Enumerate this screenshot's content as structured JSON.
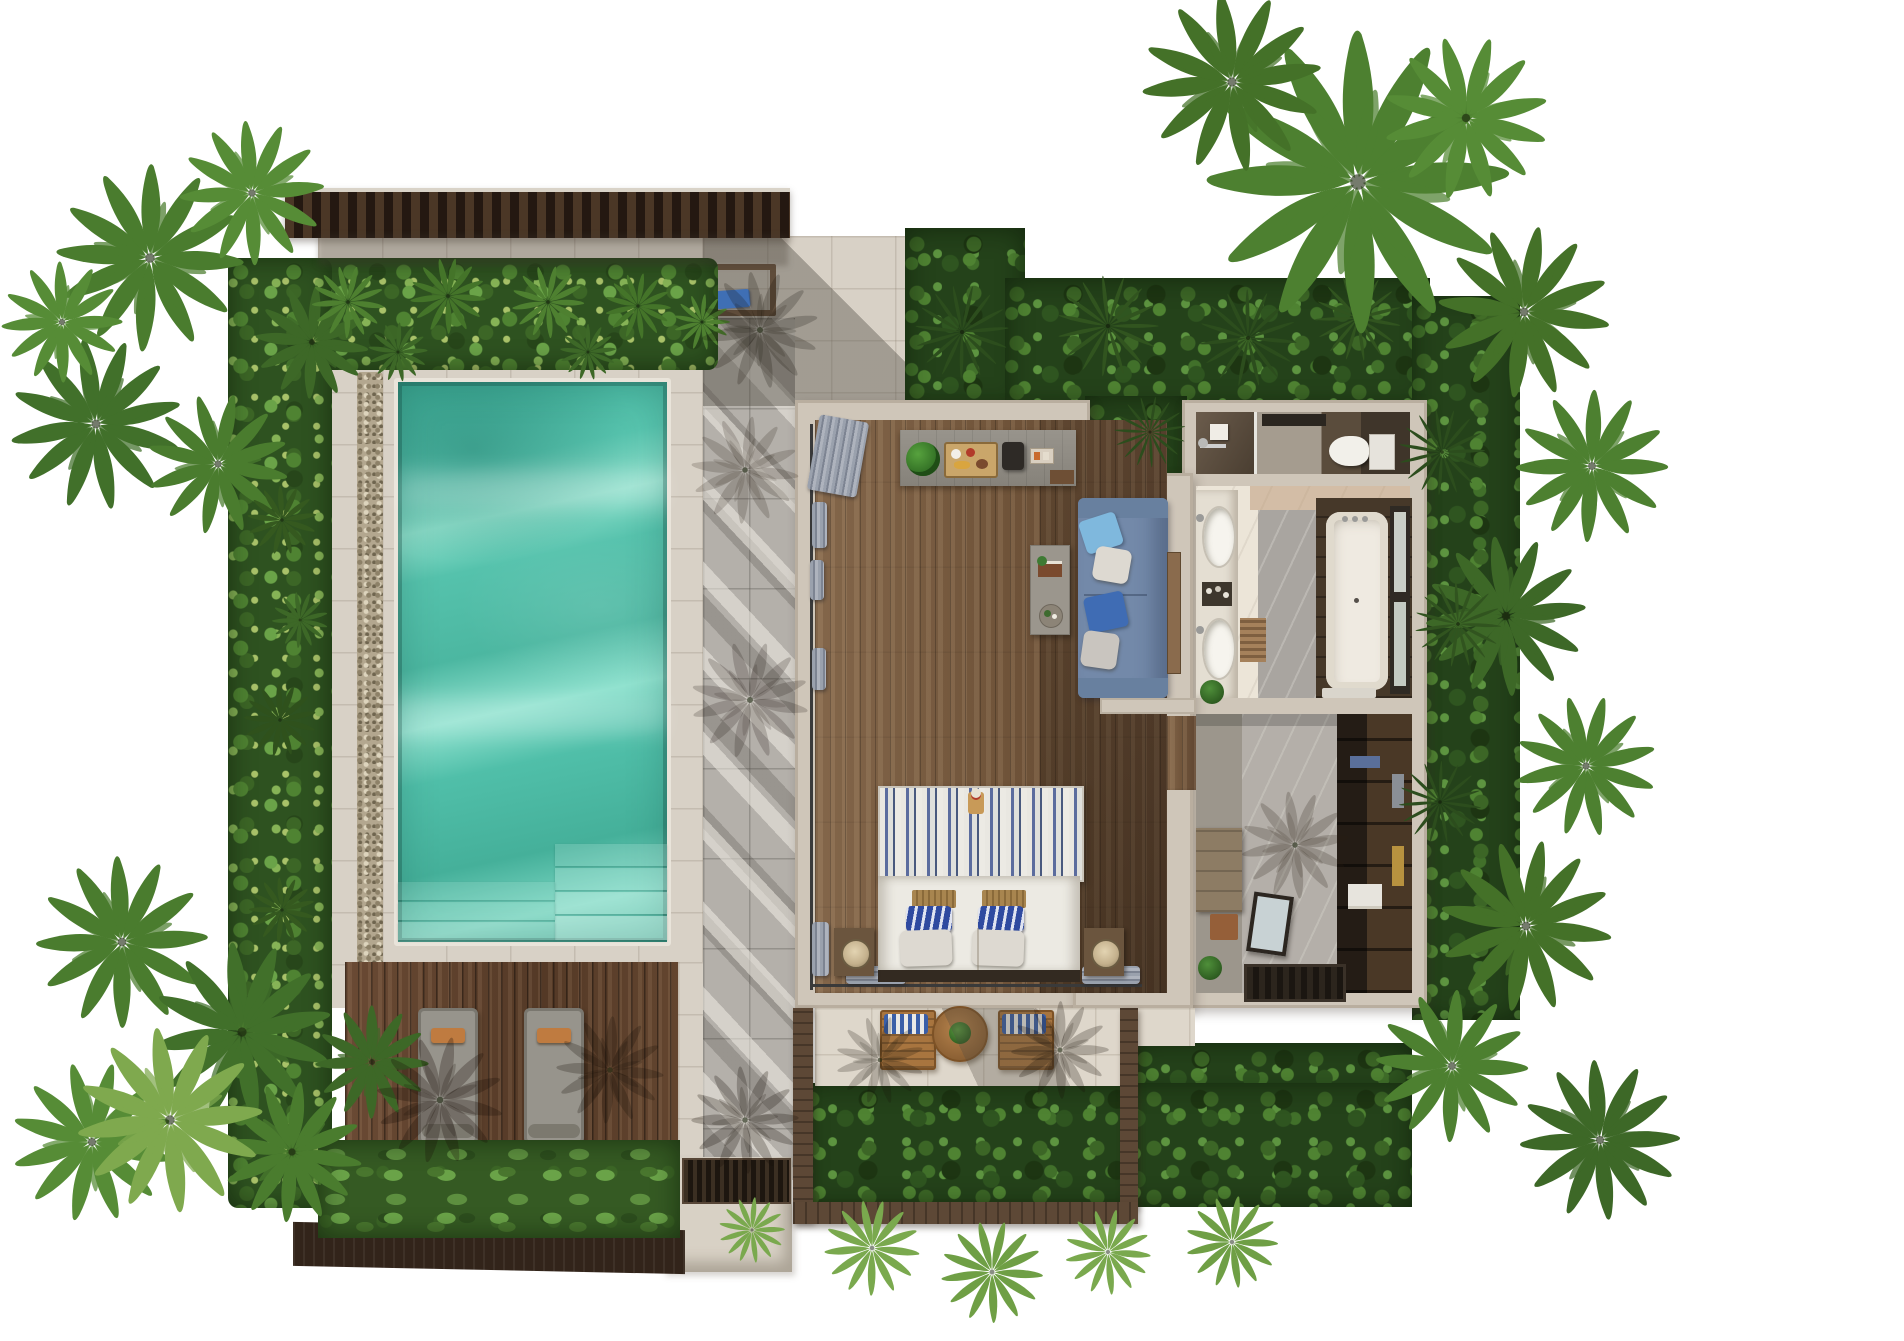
{
  "scene": {
    "type": "top-down 3D rendered floor plan",
    "setting": "tropical one-bedroom pool villa surrounded by palms and jungle hedges",
    "background": "#ffffff",
    "palette": {
      "pool_water": "#53c0aa",
      "pool_water_light": "#8fe0cc",
      "pool_water_dark": "#2e9d89",
      "stone_light": "#d8d1c6",
      "stone_terrace": "#ded7cb",
      "path_gray": "#b4b0aa",
      "gravel": "#b3a78f",
      "deck_wood": "#5e402c",
      "roof_wood": "#3a2a1c",
      "pergola_wood": "#5d4836",
      "villa_wall": "#cfc6b9",
      "wood_floor": "#7b5f45",
      "marble_cream": "#ece5d8",
      "marble_gray": "#a9a5a0",
      "sofa_blue": "#7389a9",
      "bed_stripe_blue": "#51628f",
      "pillow_blue": "#2f4aa0",
      "hedge_green": "#2e5220",
      "jungle_green": "#24421a",
      "palm_green": "#4a7c2e",
      "lounger_gray": "#97948c",
      "cushion_orange": "#bf7b40",
      "towel_blue": "#3f6fb5",
      "chair_wood": "#a8753f"
    },
    "rooms": [
      {
        "id": "bedroom",
        "label": "Bedroom & living area",
        "floor": "wide wooden planks"
      },
      {
        "id": "bathroom",
        "label": "Bathroom with double vanity and bathtub",
        "floor": "cream and gray marble"
      },
      {
        "id": "shower",
        "label": "Walk-in shower",
        "floor": "dark stone"
      },
      {
        "id": "wc",
        "label": "WC",
        "floor": "stone with dark zone"
      },
      {
        "id": "wardrobe",
        "label": "Walk-in wardrobe / dressing room",
        "floor": "marble"
      },
      {
        "id": "pool",
        "label": "Private swimming pool with corner entry steps"
      },
      {
        "id": "sundeck",
        "label": "Timber sun deck with two loungers"
      },
      {
        "id": "terrace",
        "label": "Covered terrace with chairs and round table"
      },
      {
        "id": "entry",
        "label": "Entry path and door mat"
      },
      {
        "id": "court",
        "label": "North stone court under timber roof"
      }
    ],
    "furniture": [
      "king bed with blue-white striped canopy headboard",
      "2 rattan bed trays",
      "2 blue patterned pillows",
      "2 white pillows",
      "2 nightstands with round lamps",
      "blue 3-seat sofa with 4 cushions",
      "narrow coffee table with book and round tray",
      "gray console sideboard with monstera plant, breakfast tray, coffee set and box",
      "gray curtains along glass walls",
      "double vanity with 2 oval sinks and amenity tray",
      "freestanding bathtub in dark timber deck beside window",
      "toilet",
      "rain shower with shelf",
      "dark wardrobe with clothes and shelves",
      "wooden dresser",
      "leaning mirror",
      "entry door mat",
      "2 potted plants",
      "2 gray sun loungers with orange pillows",
      "pool-side wooden bench with blue towels",
      "2 wooden terrace chairs with blue striped cushions",
      "round wooden terrace table with plant"
    ],
    "pool": {
      "steps": "corner staircase + full-width shallow entry",
      "gravel_border": true,
      "coping": "light stone"
    },
    "palms": [
      {
        "x": 150,
        "y": 258,
        "r": 96,
        "k": "c",
        "c": "#4a7c2e"
      },
      {
        "x": 252,
        "y": 193,
        "r": 74,
        "k": "c",
        "c": "#568c36"
      },
      {
        "x": 96,
        "y": 424,
        "r": 88,
        "k": "c",
        "c": "#41702a"
      },
      {
        "x": 218,
        "y": 464,
        "r": 72,
        "k": "c",
        "c": "#4a7c2e"
      },
      {
        "x": 312,
        "y": 342,
        "r": 58,
        "k": "c",
        "c": "#3d6827"
      },
      {
        "x": 62,
        "y": 322,
        "r": 62,
        "k": "c",
        "c": "#568c36"
      },
      {
        "x": 348,
        "y": 302,
        "r": 44,
        "k": "f",
        "c": "#4e8030"
      },
      {
        "x": 448,
        "y": 296,
        "r": 46,
        "k": "f",
        "c": "#447429"
      },
      {
        "x": 548,
        "y": 302,
        "r": 44,
        "k": "f",
        "c": "#4e8030"
      },
      {
        "x": 638,
        "y": 306,
        "r": 40,
        "k": "f",
        "c": "#447429"
      },
      {
        "x": 702,
        "y": 322,
        "r": 34,
        "k": "f",
        "c": "#4e8030"
      },
      {
        "x": 398,
        "y": 352,
        "r": 36,
        "k": "f",
        "c": "#3d6827"
      },
      {
        "x": 588,
        "y": 352,
        "r": 34,
        "k": "f",
        "c": "#3d6827"
      },
      {
        "x": 282,
        "y": 520,
        "r": 42,
        "k": "f",
        "c": "#35591f"
      },
      {
        "x": 280,
        "y": 720,
        "r": 44,
        "k": "f",
        "c": "#2f511c"
      },
      {
        "x": 282,
        "y": 910,
        "r": 40,
        "k": "f",
        "c": "#35591f"
      },
      {
        "x": 300,
        "y": 620,
        "r": 34,
        "k": "f",
        "c": "#3d6827"
      },
      {
        "x": 962,
        "y": 332,
        "r": 50,
        "k": "s",
        "c": "#2c4d1d"
      },
      {
        "x": 1108,
        "y": 326,
        "r": 54,
        "k": "s",
        "c": "#31541f"
      },
      {
        "x": 1248,
        "y": 338,
        "r": 52,
        "k": "s",
        "c": "#2c4d1d"
      },
      {
        "x": 1358,
        "y": 318,
        "r": 46,
        "k": "s",
        "c": "#31541f"
      },
      {
        "x": 1150,
        "y": 432,
        "r": 38,
        "k": "s",
        "c": "#2c4d1d"
      },
      {
        "x": 1358,
        "y": 182,
        "r": 155,
        "k": "c",
        "c": "#4d8030"
      },
      {
        "x": 1232,
        "y": 82,
        "r": 92,
        "k": "c",
        "c": "#447128"
      },
      {
        "x": 1466,
        "y": 118,
        "r": 84,
        "k": "c",
        "c": "#568c36"
      },
      {
        "x": 1524,
        "y": 312,
        "r": 88,
        "k": "c",
        "c": "#447128"
      },
      {
        "x": 1592,
        "y": 466,
        "r": 78,
        "k": "c",
        "c": "#4d8030"
      },
      {
        "x": 1506,
        "y": 616,
        "r": 82,
        "k": "c",
        "c": "#3d6827"
      },
      {
        "x": 1586,
        "y": 766,
        "r": 72,
        "k": "c",
        "c": "#4d8030"
      },
      {
        "x": 1526,
        "y": 926,
        "r": 88,
        "k": "c",
        "c": "#447128"
      },
      {
        "x": 1452,
        "y": 1066,
        "r": 78,
        "k": "c",
        "c": "#4d8030"
      },
      {
        "x": 1600,
        "y": 1140,
        "r": 82,
        "k": "c",
        "c": "#3d6827"
      },
      {
        "x": 1442,
        "y": 452,
        "r": 46,
        "k": "s",
        "c": "#2c4d1d"
      },
      {
        "x": 1458,
        "y": 624,
        "r": 46,
        "k": "s",
        "c": "#31541f"
      },
      {
        "x": 1440,
        "y": 802,
        "r": 44,
        "k": "s",
        "c": "#2c4d1d"
      },
      {
        "x": 122,
        "y": 942,
        "r": 88,
        "k": "c",
        "c": "#4a7c2e"
      },
      {
        "x": 242,
        "y": 1032,
        "r": 92,
        "k": "c",
        "c": "#41702a"
      },
      {
        "x": 92,
        "y": 1142,
        "r": 82,
        "k": "c",
        "c": "#568c36"
      },
      {
        "x": 292,
        "y": 1152,
        "r": 72,
        "k": "c",
        "c": "#4a7c2e"
      },
      {
        "x": 372,
        "y": 1062,
        "r": 58,
        "k": "c",
        "c": "#3d6827"
      },
      {
        "x": 170,
        "y": 1120,
        "r": 95,
        "k": "c",
        "c": "#7fa94e"
      },
      {
        "x": 872,
        "y": 1248,
        "r": 58,
        "k": "f",
        "c": "#7aa94e"
      },
      {
        "x": 992,
        "y": 1272,
        "r": 62,
        "k": "f",
        "c": "#6f9f45"
      },
      {
        "x": 1108,
        "y": 1252,
        "r": 52,
        "k": "f",
        "c": "#7aa94e"
      },
      {
        "x": 1232,
        "y": 1242,
        "r": 56,
        "k": "f",
        "c": "#6f9f45"
      },
      {
        "x": 752,
        "y": 1230,
        "r": 40,
        "k": "f",
        "c": "#7aa94e"
      },
      {
        "x": 440,
        "y": 1100,
        "r": 65,
        "k": "c",
        "c": "rgba(25,16,8,.28)"
      },
      {
        "x": 610,
        "y": 1070,
        "r": 55,
        "k": "c",
        "c": "rgba(25,16,8,.25)"
      },
      {
        "x": 745,
        "y": 1120,
        "r": 55,
        "k": "c",
        "c": "rgba(25,16,8,.26)"
      },
      {
        "x": 760,
        "y": 330,
        "r": 60,
        "k": "c",
        "c": "rgba(25,16,8,.22)"
      },
      {
        "x": 750,
        "y": 700,
        "r": 60,
        "k": "c",
        "c": "rgba(25,16,8,.20)"
      },
      {
        "x": 745,
        "y": 470,
        "r": 55,
        "k": "c",
        "c": "rgba(25,16,8,.18)"
      },
      {
        "x": 1060,
        "y": 1050,
        "r": 50,
        "k": "c",
        "c": "rgba(25,16,8,.25)"
      },
      {
        "x": 1295,
        "y": 845,
        "r": 55,
        "k": "c",
        "c": "rgba(40,32,20,.22)"
      },
      {
        "x": 880,
        "y": 1060,
        "r": 45,
        "k": "c",
        "c": "rgba(25,16,8,.22)"
      }
    ]
  }
}
